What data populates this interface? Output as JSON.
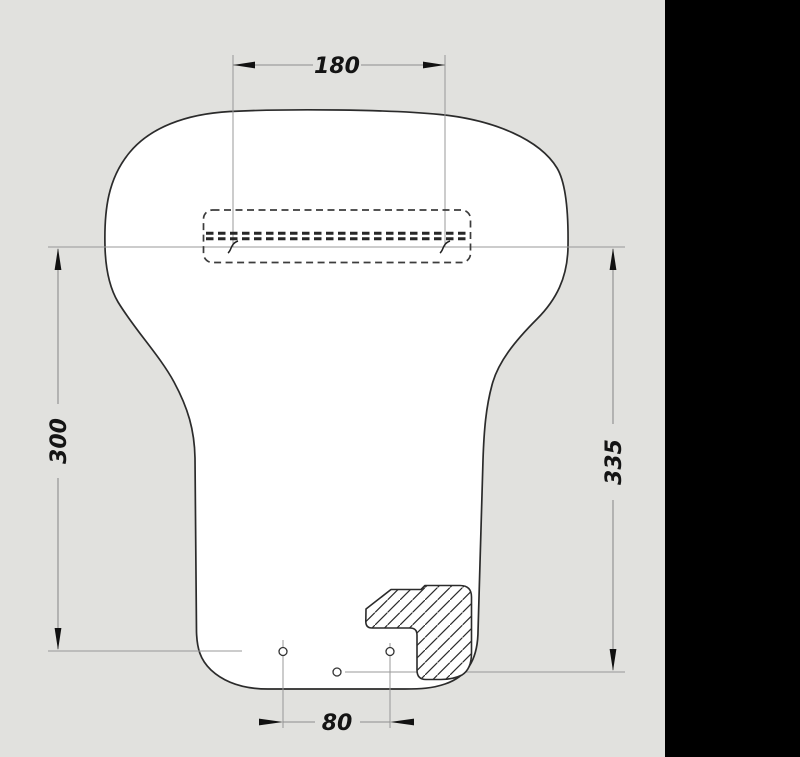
{
  "drawing": {
    "title": "panel-technical-drawing",
    "dimensions": {
      "slot_width": "180",
      "left_height": "300",
      "right_height": "335",
      "hole_spacing": "80"
    },
    "colors": {
      "background": "#e1e1de",
      "panel_fill": "#ffffff",
      "outline": "#2b2b2b",
      "thin_line": "#989898",
      "dimension_text": "#141414",
      "side_strip": "#000000"
    }
  }
}
